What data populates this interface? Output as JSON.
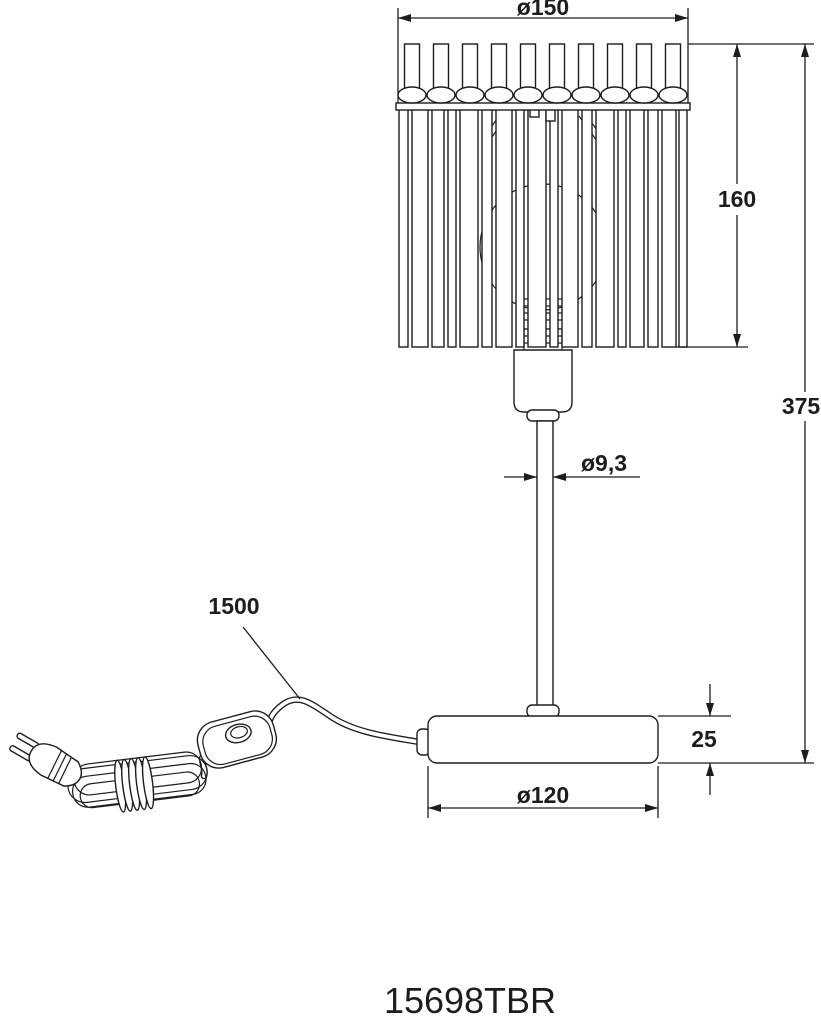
{
  "drawing": {
    "title_hint": "table lamp dimensional drawing",
    "dim_shade_diameter": "ø150",
    "dim_shade_height": "160",
    "dim_total_height": "375",
    "dim_stem_diameter": "ø9,3",
    "dim_cable_length": "1500",
    "dim_base_height": "25",
    "dim_base_diameter": "ø120",
    "product_code": "15698TBR"
  },
  "colors": {
    "line": "#1d1d1b",
    "background": "#ffffff"
  }
}
